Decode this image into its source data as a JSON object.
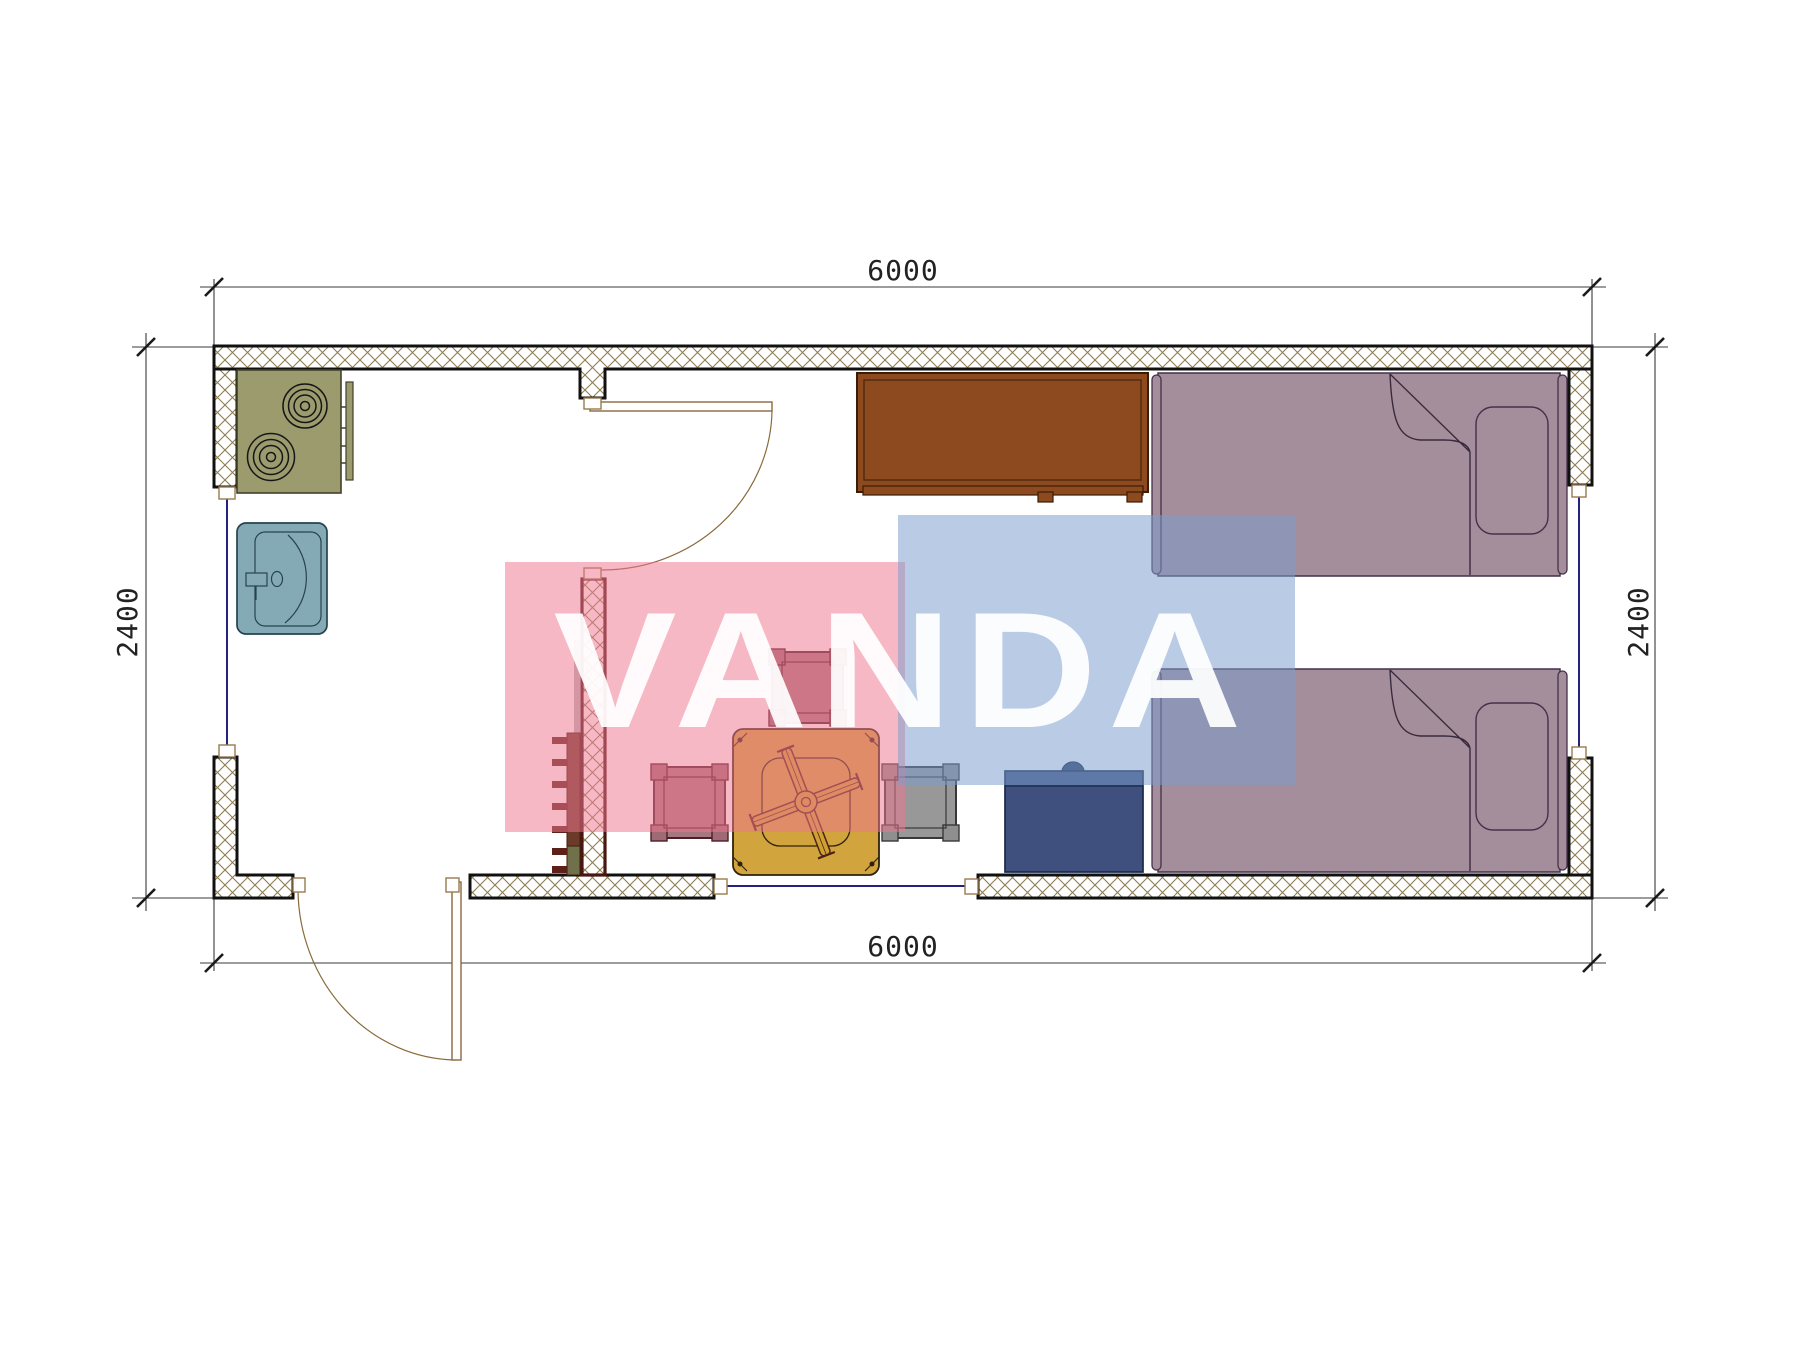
{
  "title": "cabin-floor-plan",
  "canvas": {
    "width": 1800,
    "height": 1350
  },
  "dimensions": {
    "top_width_mm": "6000",
    "bottom_width_mm": "6000",
    "left_height_mm": "2400",
    "right_height_mm": "2400"
  },
  "watermark": {
    "text": "VANDA",
    "pink_color": "#f6b9c5",
    "blue_color": "#bccfe5",
    "letter_color": "#ffffff"
  },
  "palette": {
    "wall_outline": "#111111",
    "interior_wall_outline": "#4a1612",
    "wall_hatch": "#8d7d52",
    "cooktop": "#9b9b6e",
    "sink": "#84aab6",
    "wardrobe": "#8e4a1f",
    "bed": "#a58e9b",
    "nightstand": "#40507e",
    "table": "#d0a035",
    "stool_rose": "#a06a74",
    "stool_gray": "#8f8f8f",
    "hooks": "#6b3a28",
    "window_glass": "#23237f",
    "door": "#8a6a3a",
    "dimension_line": "#3a3a3a"
  },
  "furniture": [
    "cooktop-two-burners",
    "kitchen-sink",
    "towel-rail",
    "wardrobe",
    "single-bed-top",
    "single-bed-bottom",
    "nightstand",
    "dining-table",
    "stool-top",
    "stool-left",
    "stool-right",
    "wall-hooks",
    "entrance-door",
    "interior-door",
    "window-left",
    "window-right",
    "window-bottom"
  ]
}
